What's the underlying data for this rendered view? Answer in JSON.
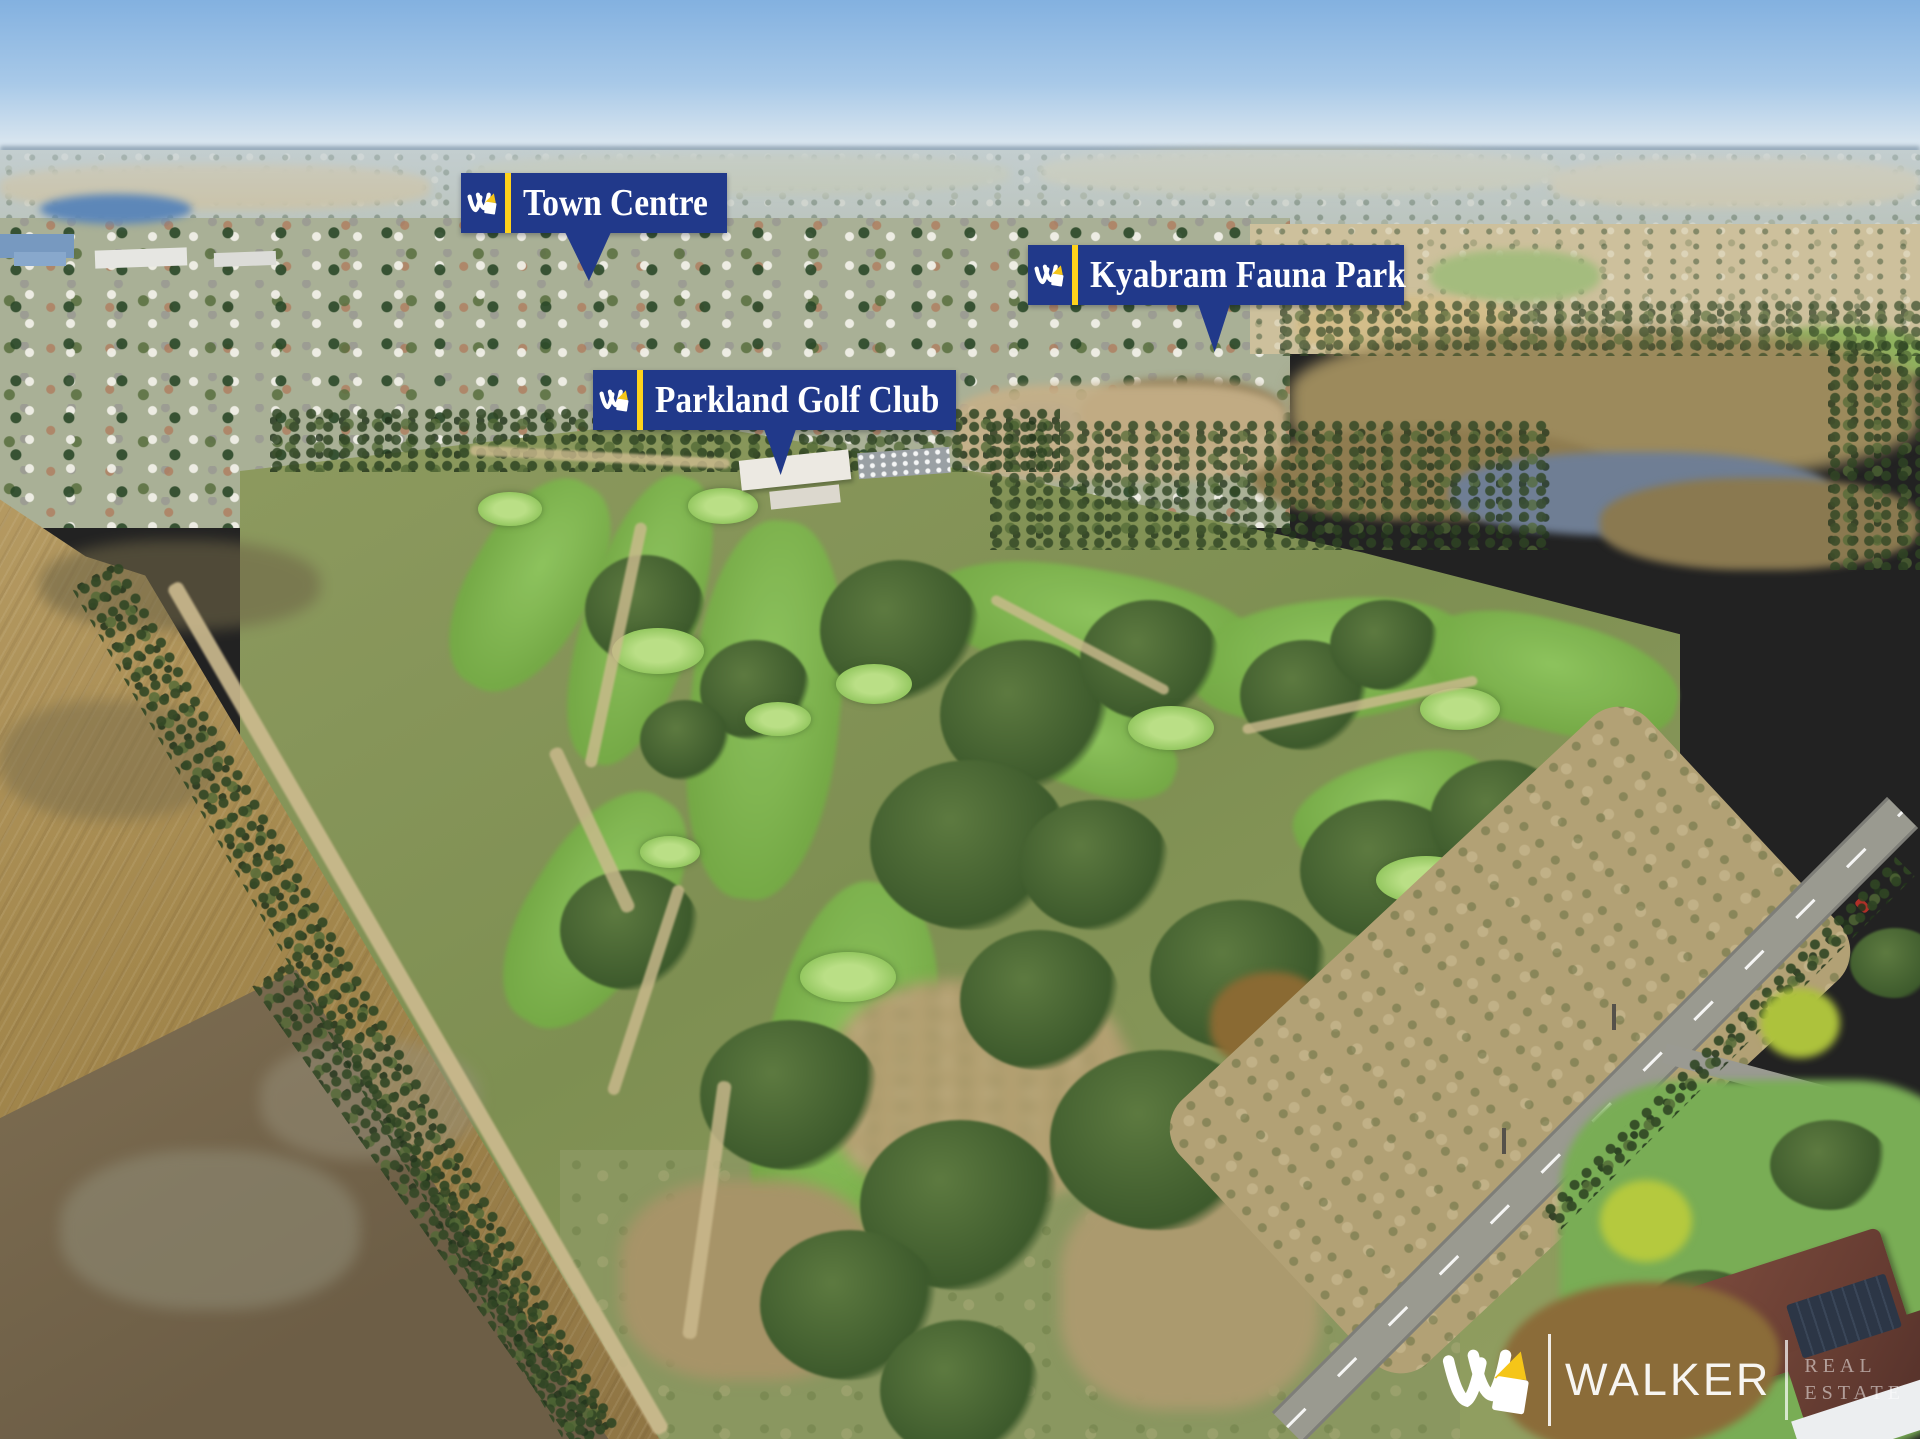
{
  "labels": {
    "town_centre": "Town Centre",
    "fauna_park": "Kyabram Fauna Park",
    "golf_club": "Parkland Golf Club"
  },
  "watermark": {
    "brand": "WALKER",
    "division_line1": "REAL",
    "division_line2": "ESTATE"
  },
  "icons": {
    "brand_mark": "walker-w-logo"
  },
  "colors": {
    "label_background": "#21398a",
    "label_accent_bar": "#ffd21c",
    "label_text": "#ffffff",
    "watermark_text": "#ffffff",
    "logo_pennant": "#f5c518"
  }
}
